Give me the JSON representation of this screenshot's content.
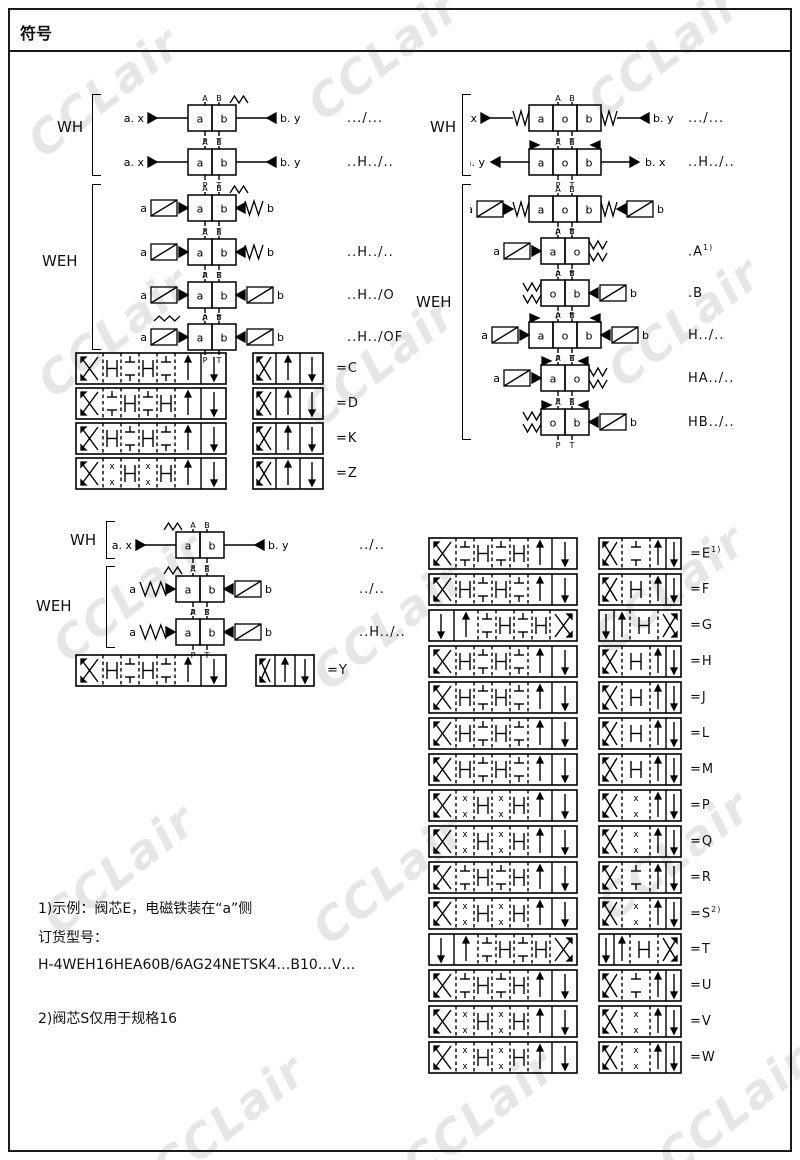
{
  "title": "符号",
  "watermark": {
    "text": "CCLair"
  },
  "groups": {
    "wh_left_top": {
      "label": "WH",
      "rows": [
        {
          "cells": [
            "a",
            "b"
          ],
          "pt": [
            "A",
            "B"
          ],
          "pb": [
            "P",
            "T"
          ],
          "left": "pilot",
          "ll": "a. x",
          "right": "pilot",
          "rl": "b. y",
          "ts": "right",
          "code": ".../..."
        },
        {
          "cells": [
            "a",
            "b"
          ],
          "pt": [
            "A",
            "B"
          ],
          "pb": [
            "P",
            "T"
          ],
          "left": "pilot",
          "ll": "a. x",
          "right": "pilot",
          "rl": "b. y",
          "ts": "",
          "code": "..H../.."
        }
      ]
    },
    "weh_left_top": {
      "label": "WEH",
      "rows": [
        {
          "cells": [
            "a",
            "b"
          ],
          "pt": [
            "A",
            "B"
          ],
          "pb": [
            "P",
            "T"
          ],
          "left": "sol",
          "ll": "a",
          "right": "arr_spring",
          "rl": "b",
          "ts": "right",
          "code": ""
        },
        {
          "cells": [
            "a",
            "b"
          ],
          "pt": [
            "A",
            "B"
          ],
          "pb": [
            "P",
            "T"
          ],
          "left": "sol",
          "ll": "a",
          "right": "arr_spring",
          "rl": "b",
          "ts": "",
          "code": "..H../.."
        },
        {
          "cells": [
            "a",
            "b"
          ],
          "pt": [
            "A",
            "B"
          ],
          "pb": [
            "P",
            "T"
          ],
          "left": "sol",
          "ll": "a",
          "right": "sol",
          "rl": "b",
          "ts": "",
          "code": "..H../O"
        },
        {
          "cells": [
            "a",
            "b"
          ],
          "pt": [
            "A",
            "B"
          ],
          "pb": [
            "P",
            "T"
          ],
          "left": "sol",
          "ll": "a",
          "right": "sol",
          "rl": "b",
          "ts": "",
          "wavy": true,
          "code": "..H../OF"
        }
      ]
    },
    "wh_right_top": {
      "label": "WH",
      "rows": [
        {
          "cells": [
            "a",
            "o",
            "b"
          ],
          "pt": [
            "A",
            "B"
          ],
          "pb": [
            "P",
            "T"
          ],
          "left": "pilot_spring",
          "ll": "a. x",
          "right": "pilot_spring",
          "rl": "b. y",
          "ts": "",
          "code": ".../..."
        },
        {
          "cells": [
            "a",
            "o",
            "b"
          ],
          "pt": [
            "A",
            "B"
          ],
          "pb": [
            "P",
            "T"
          ],
          "left": "pilot_out",
          "ll": "a. y",
          "right": "pilot_out",
          "rl": "b. x",
          "detents": true,
          "ts": "",
          "code": "..H../.."
        }
      ]
    },
    "weh_right_top": {
      "label": "WEH",
      "rows": [
        {
          "cells": [
            "a",
            "o",
            "b"
          ],
          "pt": [
            "A",
            "B"
          ],
          "pb": [
            "P",
            "T"
          ],
          "left": "sol_spring",
          "ll": "a",
          "right": "sol_spring",
          "rl": "b",
          "ts": "",
          "code": ""
        },
        {
          "cells": [
            "a",
            "o"
          ],
          "pt": [
            "A",
            "B"
          ],
          "pb": [
            "P",
            "T"
          ],
          "left": "sol",
          "ll": "a",
          "right": "spring2",
          "rl": "",
          "ts": "",
          "code": ".A",
          "sup": "1)"
        },
        {
          "cells": [
            "o",
            "b"
          ],
          "pt": [
            "A",
            "B"
          ],
          "pb": [
            "P",
            "T"
          ],
          "left": "spring2",
          "ll": "",
          "right": "sol",
          "rl": "b",
          "ts": "",
          "code": ".B"
        },
        {
          "cells": [
            "a",
            "o",
            "b"
          ],
          "pt": [
            "A",
            "B"
          ],
          "pb": [
            "P",
            "T"
          ],
          "left": "sol",
          "ll": "a",
          "right": "sol",
          "rl": "b",
          "detents": true,
          "ts": "",
          "code": "H../.."
        },
        {
          "cells": [
            "a",
            "o"
          ],
          "pt": [
            "A",
            "B"
          ],
          "pb": [
            "P",
            "T"
          ],
          "left": "sol",
          "ll": "a",
          "right": "spring2",
          "rl": "",
          "detents": true,
          "ts": "",
          "code": "HA../.."
        },
        {
          "cells": [
            "o",
            "b"
          ],
          "pt": [
            "A",
            "B"
          ],
          "pb": [
            "P",
            "T"
          ],
          "left": "spring2",
          "ll": "",
          "right": "sol",
          "rl": "b",
          "detents": true,
          "ts": "",
          "code": "HB../.."
        }
      ]
    },
    "wh_left_low": {
      "label": "WH",
      "rows": [
        {
          "cells": [
            "a",
            "b"
          ],
          "pt": [
            "A",
            "B"
          ],
          "pb": [
            "P",
            "T"
          ],
          "left": "pilot",
          "ll": "a. x",
          "right": "pilot",
          "rl": "b. y",
          "ts": "left",
          "code": "../.."
        }
      ]
    },
    "weh_left_low": {
      "label": "WEH",
      "rows": [
        {
          "cells": [
            "a",
            "b"
          ],
          "pt": [
            "A",
            "B"
          ],
          "pb": [
            "P",
            "T"
          ],
          "left": "spr_arrow",
          "ll": "a",
          "right": "sol",
          "rl": "b",
          "ts": "left",
          "code": "../.."
        },
        {
          "cells": [
            "a",
            "b"
          ],
          "pt": [
            "A",
            "B"
          ],
          "pb": [
            "P",
            "T"
          ],
          "left": "spr_arrow",
          "ll": "a",
          "right": "sol",
          "rl": "b",
          "ts": "",
          "code": "..H../.."
        }
      ]
    }
  },
  "spools": {
    "left": [
      {
        "code": "=C"
      },
      {
        "code": "=D"
      },
      {
        "code": "=K"
      },
      {
        "code": "=Z"
      }
    ],
    "y": {
      "code": "=Y"
    },
    "right": [
      {
        "code": "=E",
        "sup": "1)"
      },
      {
        "code": "=F"
      },
      {
        "code": "=G",
        "mirror": true
      },
      {
        "code": "=H"
      },
      {
        "code": "=J"
      },
      {
        "code": "=L"
      },
      {
        "code": "=M"
      },
      {
        "code": "=P"
      },
      {
        "code": "=Q"
      },
      {
        "code": "=R"
      },
      {
        "code": "=S",
        "sup": "2)"
      },
      {
        "code": "=T",
        "mirror": true
      },
      {
        "code": "=U"
      },
      {
        "code": "=V"
      },
      {
        "code": "=W"
      }
    ]
  },
  "notes": {
    "lines": [
      "1)示例：阀芯E，电磁铁装在“a”侧",
      "订货型号：",
      "H-4WEH16HEA60B/6AG24NETSK4…B10…V…",
      "2)阀芯S仅用于规格16"
    ]
  }
}
